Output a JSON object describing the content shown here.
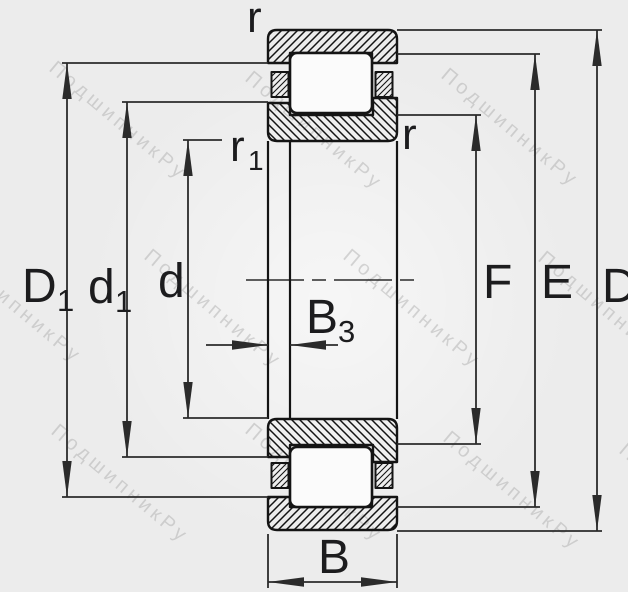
{
  "page": {
    "background": "#ececec"
  },
  "drawing": {
    "type": "cylindrical-roller-bearing-cross-section",
    "watermark": {
      "text": "ПодшипникРу",
      "color": "#a9a9a9"
    },
    "colors": {
      "outline": "#141414",
      "dimension_line": "#2b2b2b",
      "label": "#1c1c1e",
      "roller_fill": "#fbfbfb",
      "background": "#ececec"
    },
    "labels": {
      "D1": {
        "main": "D",
        "sub": "1"
      },
      "d1": {
        "main": "d",
        "sub": "1"
      },
      "d": "d",
      "F": "F",
      "E": "E",
      "D": "D",
      "B": "B",
      "B3": {
        "main": "B",
        "sub": "3"
      },
      "r_outer": "r",
      "r_inner": "r",
      "r1": {
        "main": "r",
        "sub": "1"
      }
    }
  }
}
